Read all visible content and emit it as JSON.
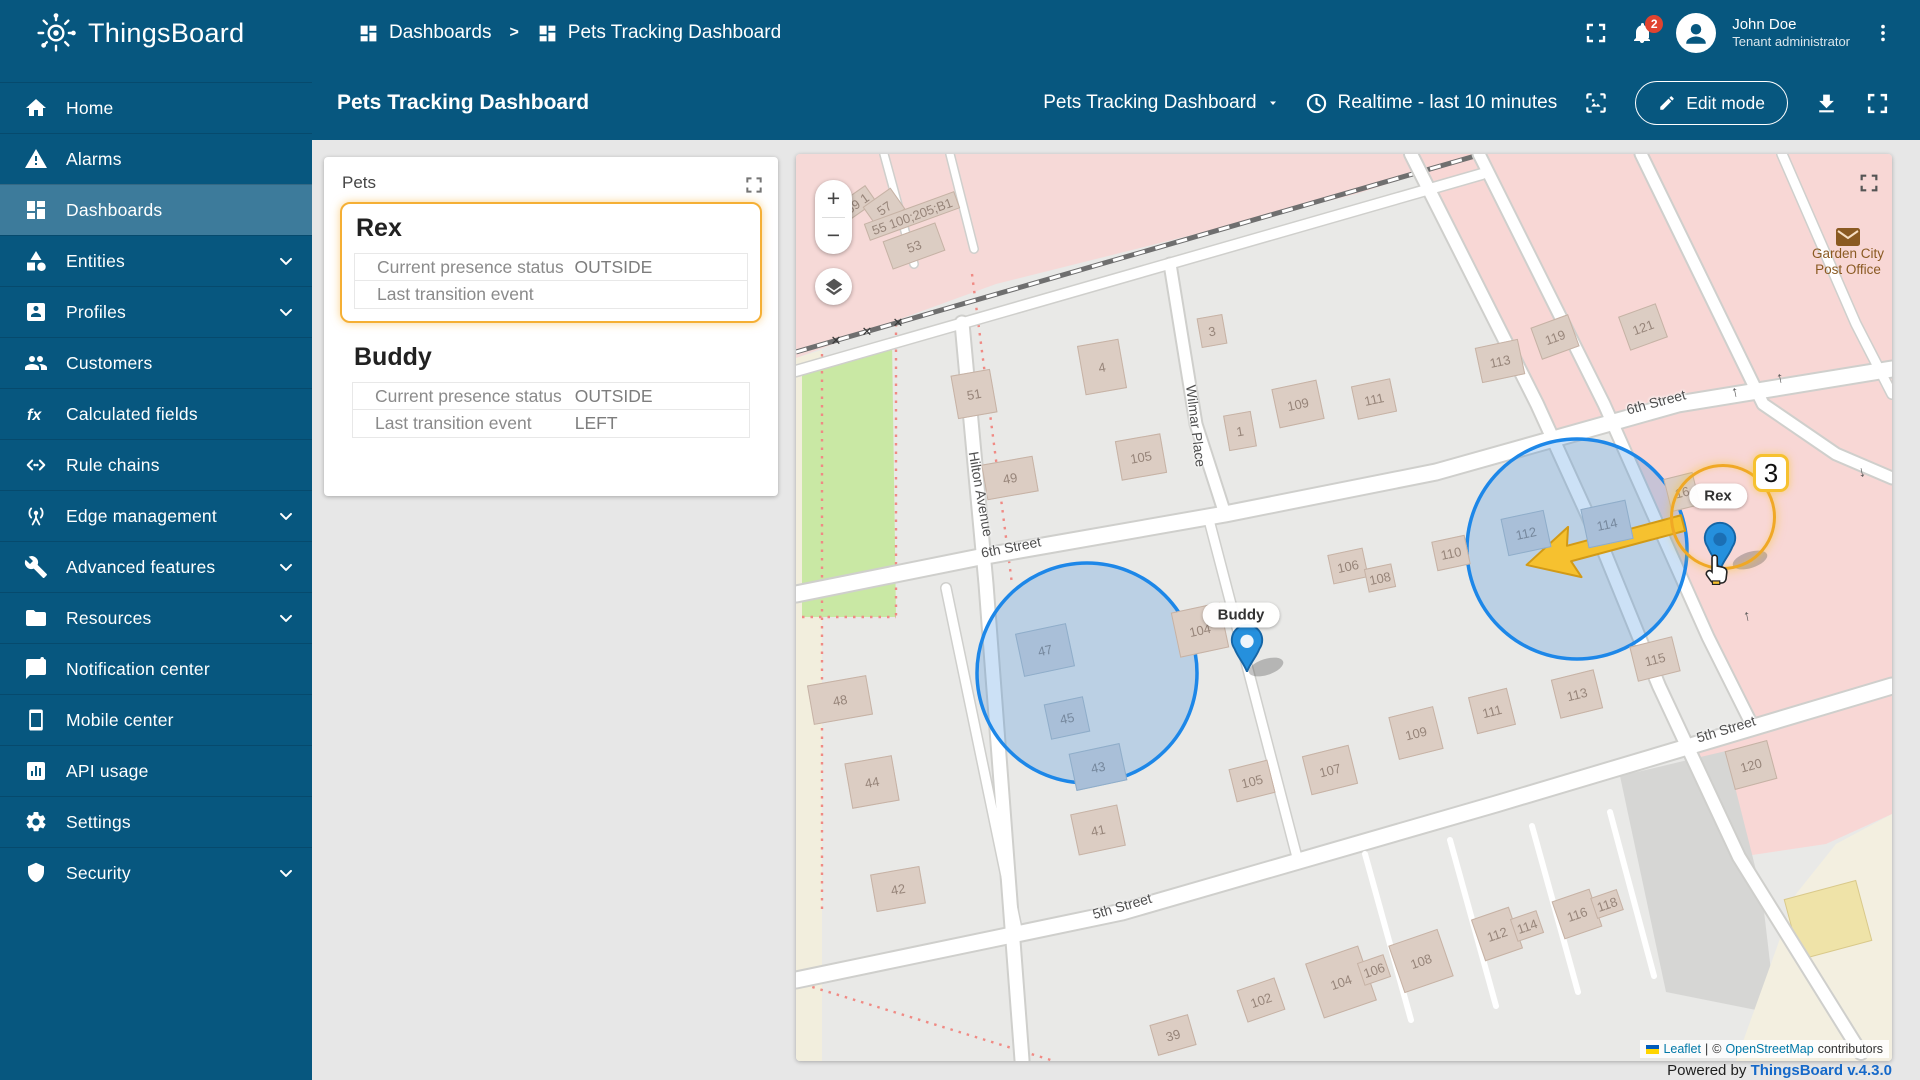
{
  "app": {
    "brand": "ThingsBoard"
  },
  "header": {
    "breadcrumb": [
      "Dashboards",
      "Pets Tracking Dashboard"
    ],
    "separator": ">",
    "user": {
      "name": "John Doe",
      "role": "Tenant administrator",
      "notifications": "2"
    }
  },
  "sidebar": {
    "items": [
      {
        "label": "Home"
      },
      {
        "label": "Alarms"
      },
      {
        "label": "Dashboards"
      },
      {
        "label": "Entities"
      },
      {
        "label": "Profiles"
      },
      {
        "label": "Customers"
      },
      {
        "label": "Calculated fields"
      },
      {
        "label": "Rule chains"
      },
      {
        "label": "Edge management"
      },
      {
        "label": "Advanced features"
      },
      {
        "label": "Resources"
      },
      {
        "label": "Notification center"
      },
      {
        "label": "Mobile center"
      },
      {
        "label": "API usage"
      },
      {
        "label": "Settings"
      },
      {
        "label": "Security"
      }
    ]
  },
  "toolbar": {
    "page_title": "Pets Tracking Dashboard",
    "dashboard_select": "Pets Tracking Dashboard",
    "timewindow": "Realtime - last 10 minutes",
    "edit": "Edit mode"
  },
  "pets_widget": {
    "title": "Pets",
    "pets": [
      {
        "name": "Rex",
        "rows": [
          {
            "label": "Current presence status",
            "value": "OUTSIDE"
          },
          {
            "label": "Last transition event",
            "value": ""
          }
        ]
      },
      {
        "name": "Buddy",
        "rows": [
          {
            "label": "Current presence status",
            "value": "OUTSIDE"
          },
          {
            "label": "Last transition event",
            "value": "LEFT"
          }
        ]
      }
    ]
  },
  "map": {
    "controls": {
      "zoom_in": "+",
      "zoom_out": "−"
    },
    "markers": [
      {
        "name": "Rex",
        "badge": "3"
      },
      {
        "name": "Buddy"
      }
    ],
    "poi": {
      "name": "Garden City Post Office"
    },
    "street_labels": [
      {
        "t": "6th Street",
        "x": 215,
        "y": 393,
        "rot": -11
      },
      {
        "t": "6th Street",
        "x": 860,
        "y": 248,
        "rot": -15
      },
      {
        "t": "5th Street",
        "x": 326,
        "y": 752,
        "rot": -16
      },
      {
        "t": "5th Street",
        "x": 930,
        "y": 575,
        "rot": -17
      },
      {
        "t": "Hilton Avenue",
        "x": 185,
        "y": 340,
        "rot": 80
      },
      {
        "t": "Wilmar Place",
        "x": 400,
        "y": 272,
        "rot": 83
      }
    ],
    "buildings": [
      {
        "t": "59 1",
        "x": 61,
        "y": 49,
        "w": 34,
        "h": 20,
        "rot": -35
      },
      {
        "t": "57",
        "x": 88,
        "y": 54,
        "w": 34,
        "h": 26,
        "rot": -35
      },
      {
        "t": "55 100;205;B1",
        "x": 116,
        "y": 62,
        "w": 96,
        "h": 18,
        "rot": -20
      },
      {
        "t": "53",
        "x": 118,
        "y": 92,
        "w": 56,
        "h": 30,
        "rot": -20
      },
      {
        "t": "51",
        "x": 178,
        "y": 240,
        "w": 40,
        "h": 44,
        "rot": -10
      },
      {
        "t": "49",
        "x": 214,
        "y": 324,
        "w": 52,
        "h": 36,
        "rot": -10
      },
      {
        "t": "4",
        "x": 306,
        "y": 213,
        "w": 42,
        "h": 50,
        "rot": -10
      },
      {
        "t": "105",
        "x": 345,
        "y": 303,
        "w": 46,
        "h": 40,
        "rot": -10
      },
      {
        "t": "3",
        "x": 416,
        "y": 177,
        "w": 26,
        "h": 30,
        "rot": -10
      },
      {
        "t": "1",
        "x": 444,
        "y": 277,
        "w": 28,
        "h": 36,
        "rot": -10
      },
      {
        "t": "109",
        "x": 502,
        "y": 250,
        "w": 46,
        "h": 40,
        "rot": -12
      },
      {
        "t": "111",
        "x": 578,
        "y": 245,
        "w": 40,
        "h": 34,
        "rot": -12
      },
      {
        "t": "113",
        "x": 704,
        "y": 207,
        "w": 44,
        "h": 36,
        "rot": -12
      },
      {
        "t": "119",
        "x": 759,
        "y": 183,
        "w": 40,
        "h": 34,
        "rot": -20
      },
      {
        "t": "121",
        "x": 847,
        "y": 173,
        "w": 40,
        "h": 36,
        "rot": -20
      },
      {
        "t": "110",
        "x": 655,
        "y": 399,
        "w": 34,
        "h": 30,
        "rot": -12
      },
      {
        "t": "112",
        "x": 730,
        "y": 379,
        "w": 44,
        "h": 38,
        "rot": -12,
        "blue": true
      },
      {
        "t": "114",
        "x": 811,
        "y": 370,
        "w": 46,
        "h": 40,
        "rot": -12,
        "blue": true
      },
      {
        "t": "16",
        "x": 886,
        "y": 338,
        "w": 30,
        "h": 34,
        "rot": -14
      },
      {
        "t": "115",
        "x": 859,
        "y": 505,
        "w": 44,
        "h": 36,
        "rot": -14
      },
      {
        "t": "106",
        "x": 552,
        "y": 412,
        "w": 36,
        "h": 30,
        "rot": -12
      },
      {
        "t": "108",
        "x": 584,
        "y": 424,
        "w": 28,
        "h": 24,
        "rot": -12
      },
      {
        "t": "104",
        "x": 404,
        "y": 476,
        "w": 50,
        "h": 46,
        "rot": -12
      },
      {
        "t": "47",
        "x": 249,
        "y": 496,
        "w": 52,
        "h": 44,
        "rot": -12,
        "blue": true
      },
      {
        "t": "45",
        "x": 271,
        "y": 564,
        "w": 40,
        "h": 36,
        "rot": -12,
        "blue": true
      },
      {
        "t": "43",
        "x": 302,
        "y": 613,
        "w": 52,
        "h": 38,
        "rot": -12,
        "blue": true
      },
      {
        "t": "41",
        "x": 302,
        "y": 676,
        "w": 48,
        "h": 42,
        "rot": -12
      },
      {
        "t": "48",
        "x": 44,
        "y": 546,
        "w": 60,
        "h": 40,
        "rot": -10
      },
      {
        "t": "44",
        "x": 76,
        "y": 628,
        "w": 48,
        "h": 46,
        "rot": -10
      },
      {
        "t": "42",
        "x": 102,
        "y": 735,
        "w": 50,
        "h": 38,
        "rot": -10
      },
      {
        "t": "107",
        "x": 534,
        "y": 616,
        "w": 48,
        "h": 40,
        "rot": -14
      },
      {
        "t": "109",
        "x": 620,
        "y": 579,
        "w": 46,
        "h": 44,
        "rot": -14
      },
      {
        "t": "111",
        "x": 696,
        "y": 557,
        "w": 40,
        "h": 38,
        "rot": -14
      },
      {
        "t": "113",
        "x": 781,
        "y": 540,
        "w": 44,
        "h": 40,
        "rot": -14
      },
      {
        "t": "105",
        "x": 456,
        "y": 627,
        "w": 40,
        "h": 34,
        "rot": -14
      },
      {
        "t": "104",
        "x": 545,
        "y": 828,
        "w": 56,
        "h": 58,
        "rot": -19
      },
      {
        "t": "106",
        "x": 578,
        "y": 816,
        "w": 28,
        "h": 24,
        "rot": -19
      },
      {
        "t": "108",
        "x": 625,
        "y": 807,
        "w": 52,
        "h": 50,
        "rot": -19
      },
      {
        "t": "112",
        "x": 701,
        "y": 780,
        "w": 40,
        "h": 44,
        "rot": -19
      },
      {
        "t": "114",
        "x": 731,
        "y": 772,
        "w": 28,
        "h": 24,
        "rot": -19
      },
      {
        "t": "116",
        "x": 781,
        "y": 760,
        "w": 40,
        "h": 40,
        "rot": -19
      },
      {
        "t": "118",
        "x": 811,
        "y": 750,
        "w": 28,
        "h": 22,
        "rot": -19
      },
      {
        "t": "102",
        "x": 465,
        "y": 846,
        "w": 40,
        "h": 34,
        "rot": -19
      },
      {
        "t": "39",
        "x": 377,
        "y": 881,
        "w": 40,
        "h": 32,
        "rot": -16
      },
      {
        "t": "120",
        "x": 955,
        "y": 611,
        "w": 44,
        "h": 40,
        "rot": -15
      }
    ],
    "attribution": {
      "leaflet": "Leaflet",
      "divider": "|",
      "copyright": "©",
      "osm": "OpenStreetMap",
      "suffix": "contributors"
    }
  },
  "footer": {
    "text": "Powered by",
    "version": "ThingsBoard v.4.3.0"
  }
}
